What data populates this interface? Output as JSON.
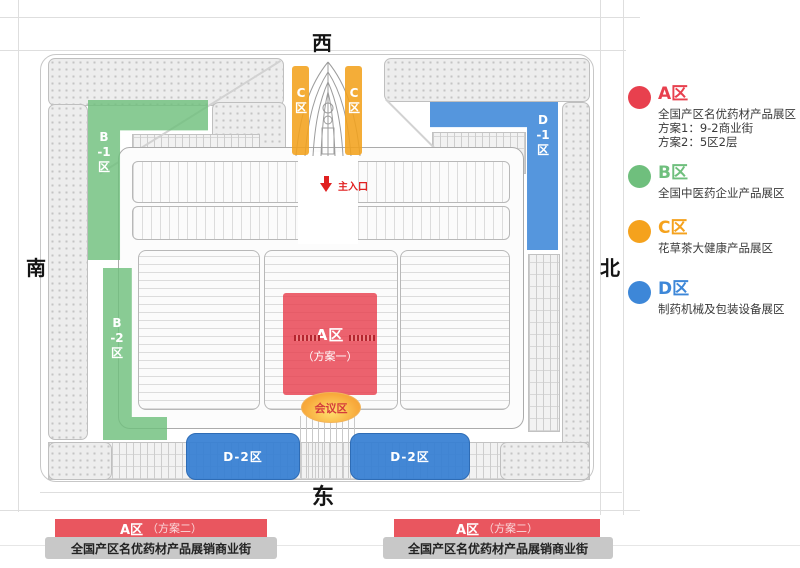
{
  "colors": {
    "zone_a_red": "#E8404E",
    "zone_b_green": "#6FBF7D",
    "zone_c_orange": "#F5A21D",
    "zone_d_blue": "#3D87D8",
    "banner_red": "#E9565F",
    "banner_gray": "#C8C8C8",
    "entrance_red": "#E02020"
  },
  "compass": {
    "west": "西",
    "south": "南",
    "north": "北",
    "east": "东"
  },
  "plan": {
    "entrance_label": "主入口",
    "zone_a": {
      "title": "A区",
      "subtitle": "（方案一）"
    },
    "conference_label": "会议区",
    "zone_c_left": "C区",
    "zone_c_right": "C区",
    "zone_b1": "B-1区",
    "zone_b2": "B-2区",
    "zone_d1": "D-1区",
    "zone_d2_left": "D-2区",
    "zone_d2_right": "D-2区"
  },
  "legend": {
    "items": [
      {
        "title": "A区",
        "color": "#E8404E",
        "lines": [
          "全国产区名优药材产品展区",
          "方案1：9-2商业街",
          "方案2：5区2层"
        ]
      },
      {
        "title": "B区",
        "color": "#6FBF7D",
        "lines": [
          "全国中医药企业产品展区"
        ]
      },
      {
        "title": "C区",
        "color": "#F5A21D",
        "lines": [
          "花草茶大健康产品展区"
        ]
      },
      {
        "title": "D区",
        "color": "#3D87D8",
        "lines": [
          "制药机械及包装设备展区"
        ]
      }
    ]
  },
  "banners": [
    {
      "title": "A区",
      "subtitle": "（方案二）",
      "description": "全国产区名优药材产品展销商业街"
    },
    {
      "title": "A区",
      "subtitle": "（方案二）",
      "description": "全国产区名优药材产品展销商业街"
    }
  ]
}
